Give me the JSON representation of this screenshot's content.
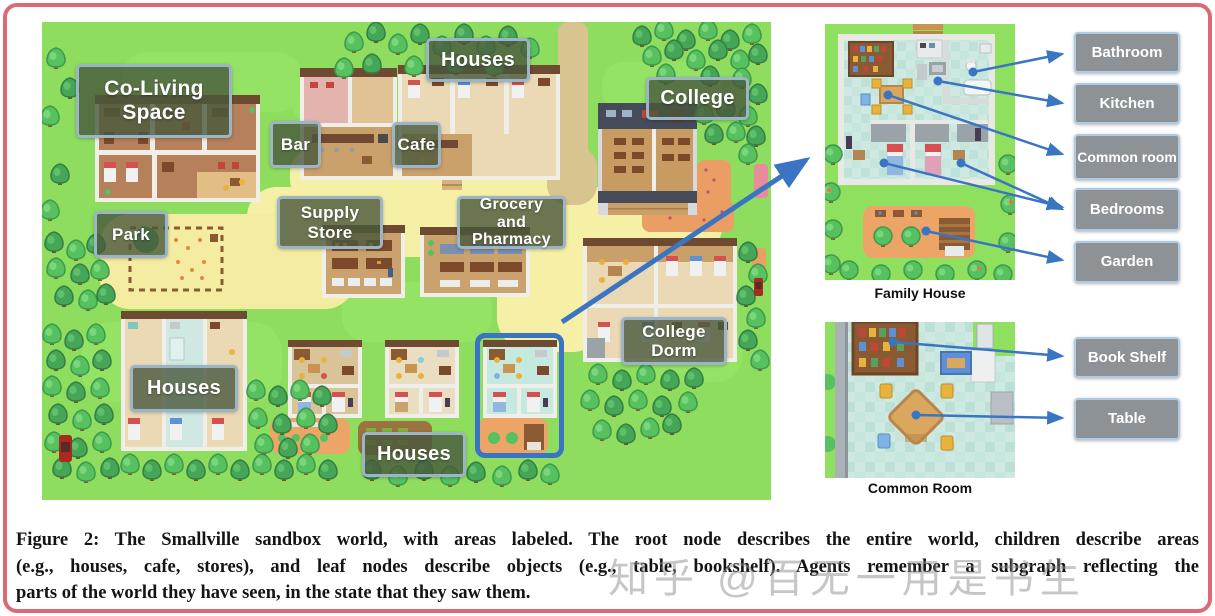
{
  "page": {
    "type": "paper-figure"
  },
  "colors": {
    "accent_blue": "#3a75c4",
    "map_label_bg": "rgba(72,88,60,0.8)",
    "map_label_border": "#9bb4c6",
    "tag_bg": "#8d9296",
    "tag_border": "#aecbe3",
    "page_border": "#dd6976"
  },
  "map": {
    "labels": [
      {
        "id": "co-living-space",
        "text": "Co-Living Space"
      },
      {
        "id": "houses-top",
        "text": "Houses"
      },
      {
        "id": "college",
        "text": "College"
      },
      {
        "id": "bar",
        "text": "Bar"
      },
      {
        "id": "cafe",
        "text": "Cafe"
      },
      {
        "id": "supply-store",
        "text": "Supply Store"
      },
      {
        "id": "grocery-and-pharmacy",
        "text": "Grocery and Pharmacy"
      },
      {
        "id": "park",
        "text": "Park"
      },
      {
        "id": "college-dorm",
        "text": "College Dorm"
      },
      {
        "id": "houses-bottom-left",
        "text": "Houses"
      },
      {
        "id": "houses-bottom-center",
        "text": "Houses"
      }
    ]
  },
  "detail_panels": [
    {
      "caption": "Family House",
      "labels": [
        "Bathroom",
        "Kitchen",
        "Common room",
        "Bedrooms",
        "Garden"
      ]
    },
    {
      "caption": "Common Room",
      "labels": [
        "Book Shelf",
        "Table"
      ]
    }
  ],
  "figure_caption": {
    "lines": [
      "Figure 2: The Smallville sandbox world, with areas labeled. The root node describes the entire world, children describe areas",
      "(e.g., houses, cafe, stores), and leaf nodes describe objects (e.g., table, bookshelf). Agents remember a subgraph reflecting the",
      "parts of the world they have seen, in the state that they saw them."
    ]
  },
  "watermark": "知乎 @百无一用是书生"
}
